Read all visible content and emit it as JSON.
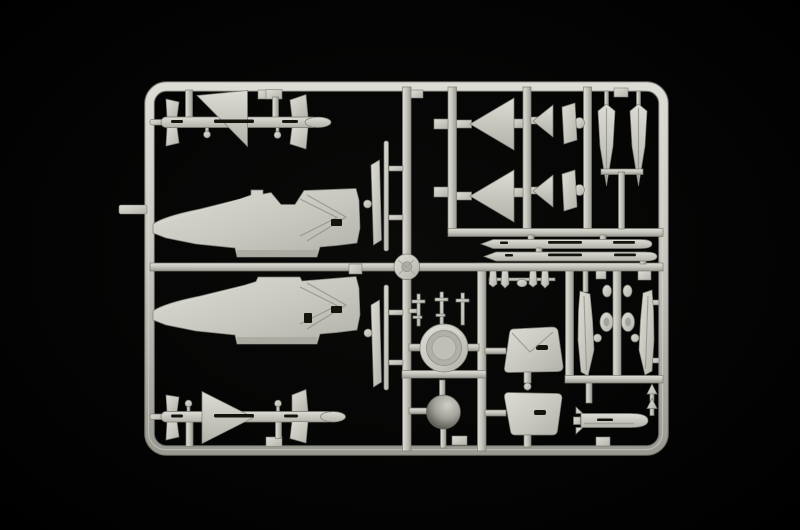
{
  "scene": {
    "description": "Photograph of a single light-grey injection-moulded plastic model kit sprue (parts runner) for a jet aircraft kit, lying on a pitch-black background. The rectangular rounded-corner runner frame holds: two long fuselage halves with pointed noses facing left, two air-to-air missiles with large triangular delta wings, two large delta fins, two small fins, two edge-on wing/stabilizer blades, two finned drop-tank halves, two slender rocket/missile bodies, an engine exhaust ring, a dark shaded radome dome, two trapezoidal intake panels, landing-gear doors with four small wheels, a small under-wing pod, tiny struts, masts and dart-shaped parts, plus a round injection-gate disc at the sprue centre.",
    "colors": {
      "bg": "#020202",
      "plastic": "#c7c7bf",
      "plastic_light": "#dcdcd4",
      "plastic_mid": "#b2b2aa",
      "plastic_dark": "#9a9a92",
      "edge": "#7c7c74",
      "recess": "#14140f",
      "crease": "#8f8f87"
    }
  },
  "parts": [
    {
      "id": "sprue-frame",
      "label": "rounded rectangular runner frame",
      "count": 1
    },
    {
      "id": "fuselage-half",
      "label": "fuselage half, nose pointing left",
      "count": 2
    },
    {
      "id": "missile-with-delta-wing",
      "label": "air-to-air missile with large triangular wing",
      "count": 2
    },
    {
      "id": "large-delta-fin",
      "label": "large triangular delta fin",
      "count": 2
    },
    {
      "id": "small-fin",
      "label": "small triangular fin",
      "count": 2
    },
    {
      "id": "stabilator-blade",
      "label": "narrow stabilizer blade",
      "count": 2
    },
    {
      "id": "drop-tank-half",
      "label": "finned drop-tank half, point down",
      "count": 2
    },
    {
      "id": "slender-rocket",
      "label": "long slender missile body",
      "count": 2
    },
    {
      "id": "edge-on-wing",
      "label": "thin wing part seen edge-on",
      "count": 2
    },
    {
      "id": "exhaust-ring",
      "label": "circular engine exhaust ring",
      "count": 1
    },
    {
      "id": "radome-dome",
      "label": "shaded hemispherical radome",
      "count": 1
    },
    {
      "id": "intake-panel",
      "label": "trapezoidal intake/duct panel",
      "count": 2
    },
    {
      "id": "gear-door",
      "label": "narrow landing-gear door blade",
      "count": 2
    },
    {
      "id": "wheel",
      "label": "small oval wheel",
      "count": 4
    },
    {
      "id": "underwing-pod",
      "label": "small finned pod/bomb",
      "count": 1
    },
    {
      "id": "dart-part",
      "label": "tiny dart-shaped part",
      "count": 2
    },
    {
      "id": "strut-cluster",
      "label": "tiny landing-gear struts",
      "count": 1
    },
    {
      "id": "mast-parts",
      "label": "thin antenna/gear masts",
      "count": 1
    },
    {
      "id": "gate-disc",
      "label": "round injection gate disc at sprue centre",
      "count": 1
    }
  ]
}
